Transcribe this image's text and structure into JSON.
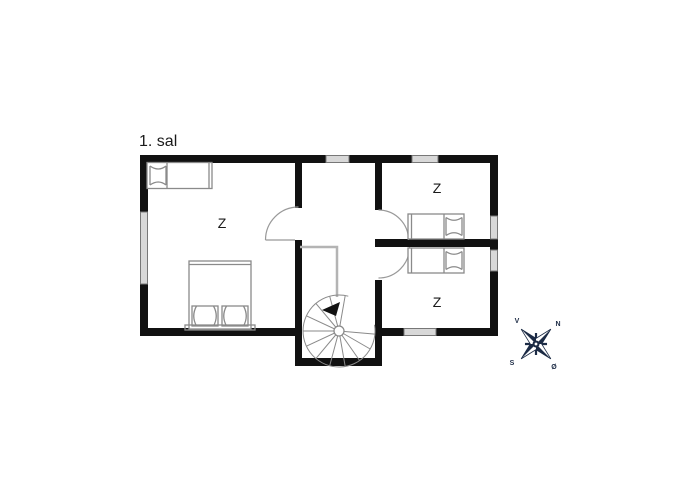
{
  "plan": {
    "title": "1. sal",
    "rooms": [
      {
        "name": "bedroom-left",
        "label": "Z"
      },
      {
        "name": "bedroom-top-right",
        "label": "Z"
      },
      {
        "name": "bedroom-bottom-right",
        "label": "Z"
      }
    ]
  },
  "compass": {
    "north": "N",
    "south": "S",
    "east": "Ø",
    "west": "V"
  },
  "colors": {
    "wall": "#111111",
    "furniture_line": "#8a8a8a",
    "window_fill": "#d8d8d8",
    "railing": "#b4b4b4",
    "compass": "#1c2b45",
    "text": "#1a1a1a"
  }
}
